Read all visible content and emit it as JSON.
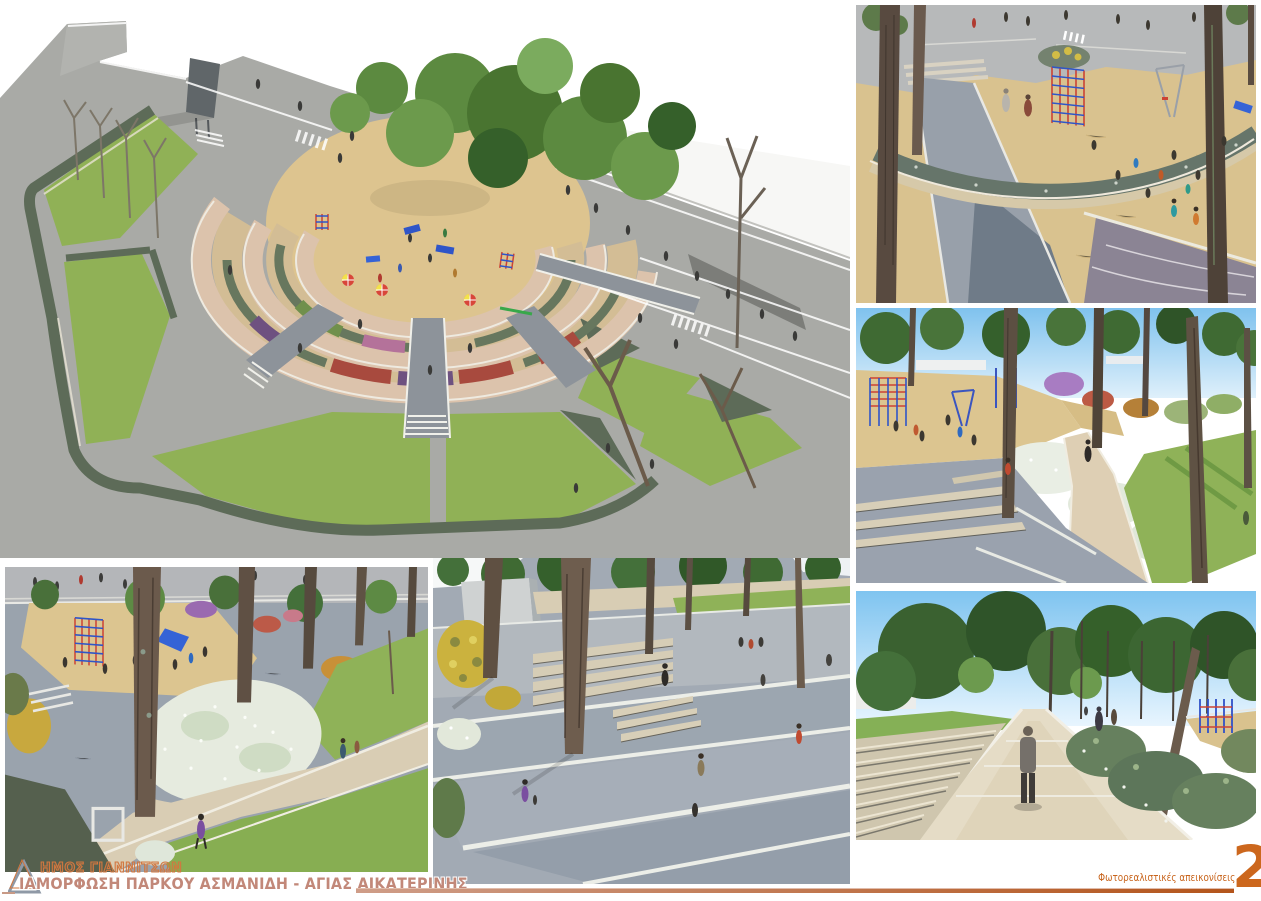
{
  "board": {
    "municipality": "ΔΗΜΟΣ ΓΙΑΝΝΙΤΣΩΝ",
    "municipality_display": "ΗΜΟΣ ΓΙΑΝΝΙΤΣΩΝ",
    "project_title": "ΔΙΑΜΟΡΦΩΣΗ ΠΑΡΚΟΥ ΑΣΜΑΝΙΔΗ - ΑΓΙΑΣ ΑΙΚΑΤΕΡΙΝΗΣ",
    "project_title_display": "ΙΑΜΟΡΦΩΣΗ ΠΑΡΚΟΥ ΑΣΜΑΝΙΔΗ - ΑΓΙΑΣ ΑΙΚΑΤΕΡΙΝΗΣ",
    "logo_letter": "Δ",
    "footer_caption": "Φωτορεαλιστικές απεικονίσεις",
    "sheet_number": "2",
    "colors": {
      "accent_orange": "#c8641c",
      "sheet_number_orange": "#cc671d",
      "title_salmon": "#c28879",
      "municipality_outline": "#d2773f",
      "rule_dark": "#b4551b",
      "rule_light": "#cf9d88",
      "road_gray": "#a9aaa6",
      "cobble_gray": "#9aa3ad",
      "lawn_green": "#90b156",
      "woodchip_tan": "#dcc48f",
      "terrace_path_pink": "#dcc3ac",
      "hedge_green": "#5d6b58",
      "sky_blue": "#7fc3ee",
      "play_equipment_blue": "#2f55c8",
      "play_equipment_red": "#cc4334"
    },
    "panels": [
      {
        "id": "aerial-overview"
      },
      {
        "id": "playground-closeup"
      },
      {
        "id": "playground-path"
      },
      {
        "id": "flower-meadow"
      },
      {
        "id": "terraced-plaza"
      },
      {
        "id": "central-walkway"
      }
    ]
  }
}
